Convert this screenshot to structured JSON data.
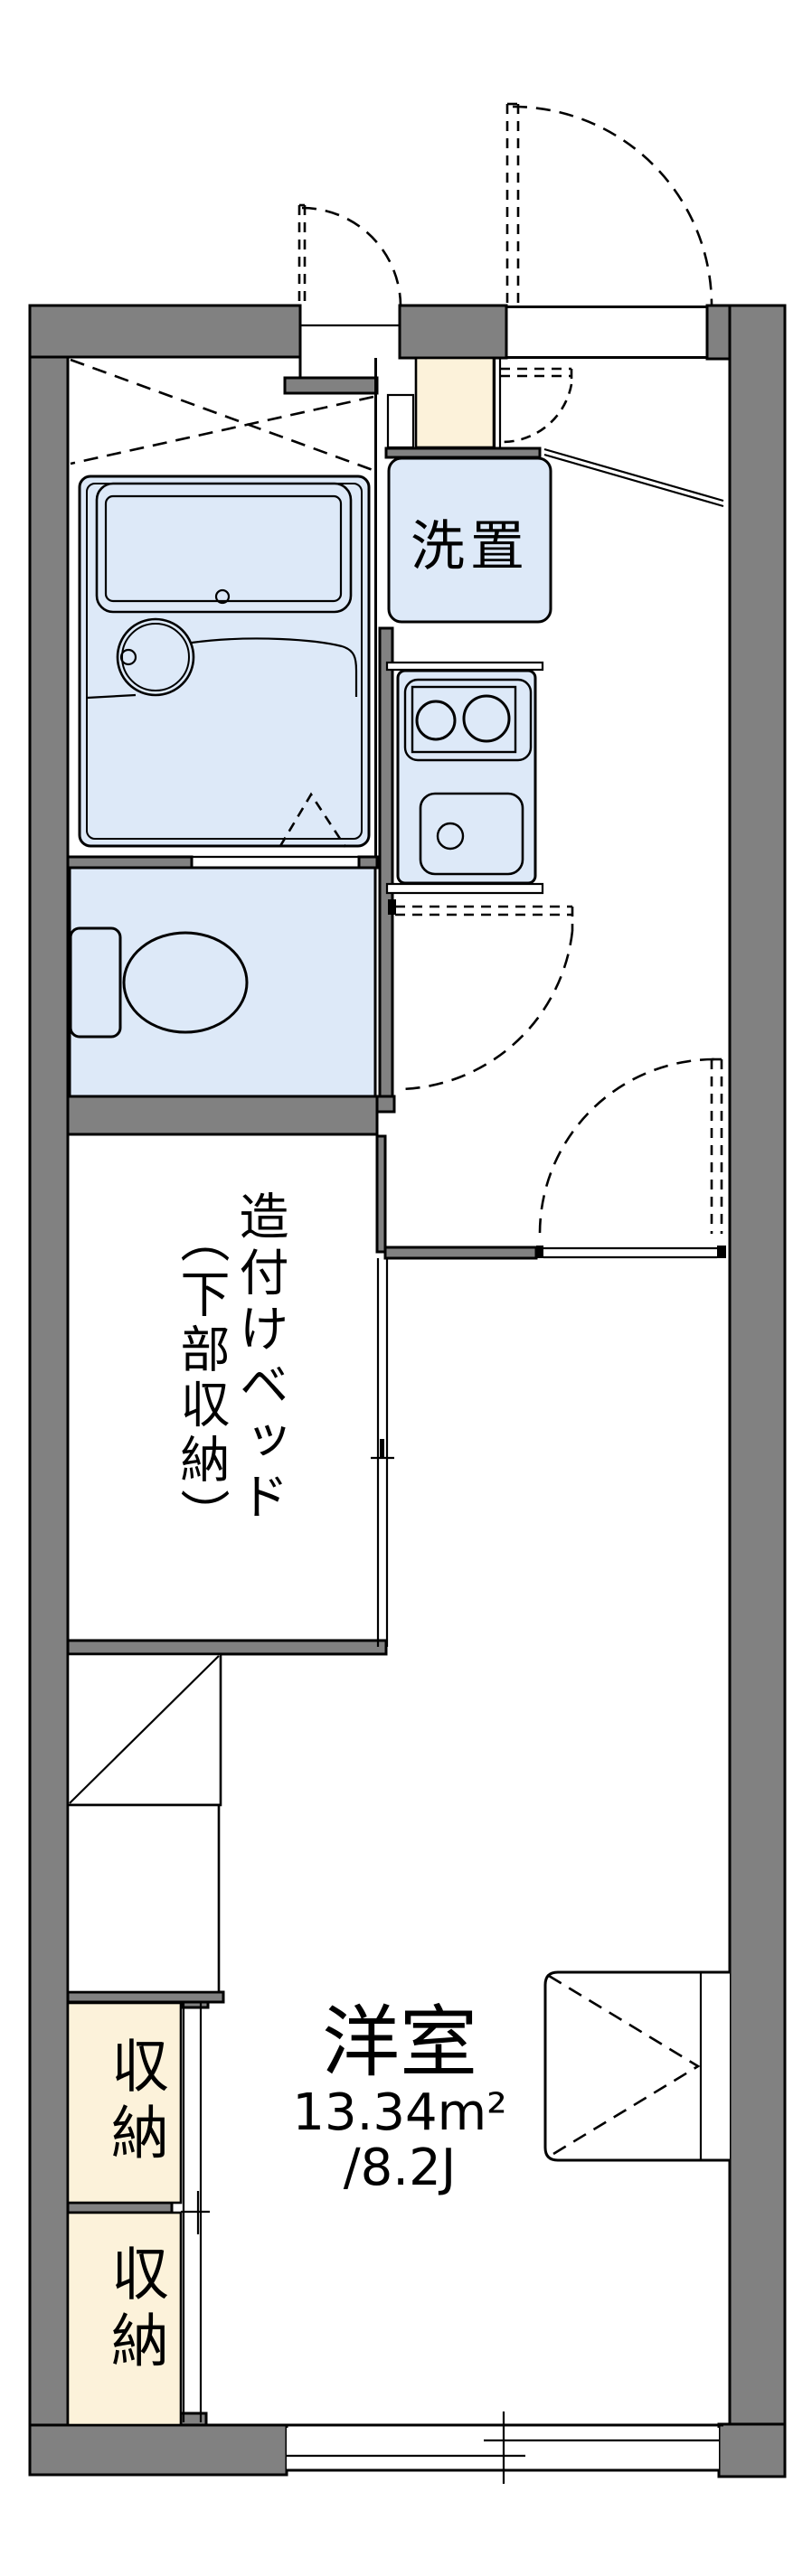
{
  "colors": {
    "wall": "#818181",
    "fixture_blue": "#dde9f8",
    "storage_cream": "#fcf2da",
    "line": "#000000",
    "background": "#ffffff"
  },
  "labels": {
    "washer": "洗置",
    "built_in_bed_line1": "造付けベッド",
    "built_in_bed_line2": "（下部収納）",
    "western_room": {
      "name": "洋室",
      "area_sqm": "13.34m²",
      "area_tatami": "/8.2J"
    },
    "storage_upper": "収納",
    "storage_lower": "収納"
  }
}
